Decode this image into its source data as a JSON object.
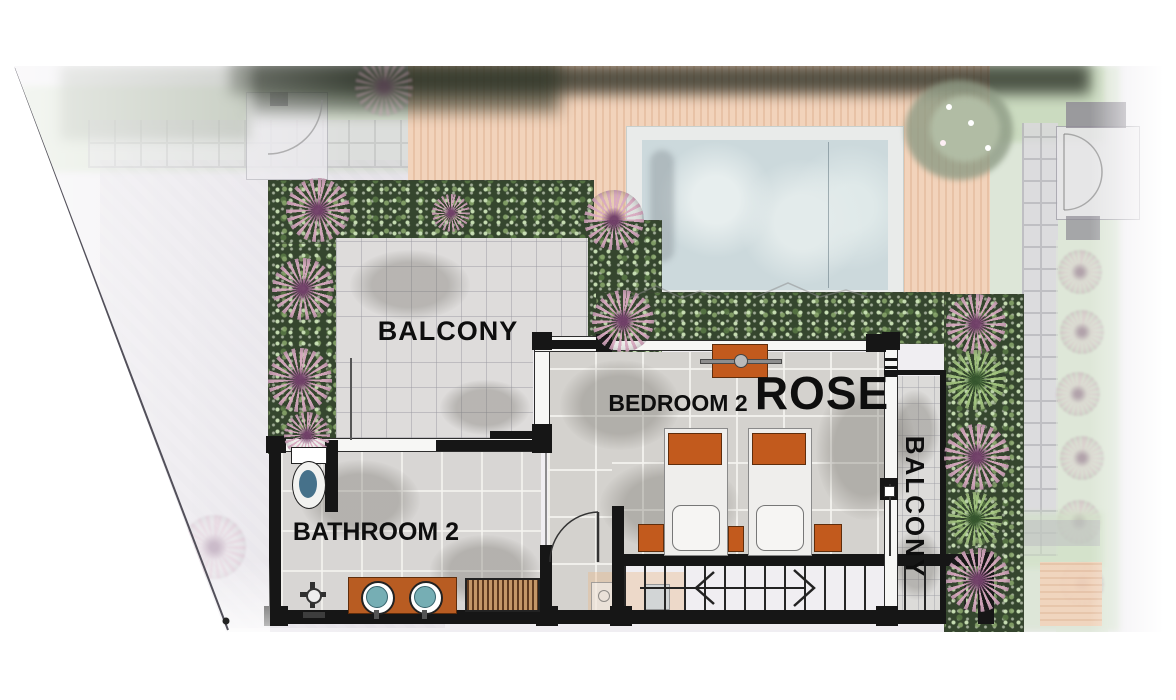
{
  "meta": {
    "type": "villa-upper-floor-plan"
  },
  "rooms": {
    "balcony_upper": {
      "label": "BALCONY"
    },
    "bedroom2": {
      "label": "BEDROOM 2"
    },
    "suite": {
      "label": "ROSE"
    },
    "balcony_side": {
      "label": "BALCONY"
    },
    "bathroom2": {
      "label": "BATHROOM 2"
    }
  },
  "features": [
    "swimming-pool",
    "timber-deck",
    "planter-hedge",
    "stepping-stones",
    "staircase",
    "twin-beds",
    "wardrobe",
    "double-vanity-sinks",
    "toilet",
    "shower",
    "entry-gate",
    "door-swing",
    "direction-arrow"
  ],
  "colors": {
    "deck": "#f0cfb4",
    "pool_water": "#ccd9dc",
    "hedge": "#35462e",
    "flower_pink": "#d0a4bc",
    "furniture_orange": "#c25a1d",
    "sink_teal": "#76aeb4",
    "tile_grey": "#d6d4d1",
    "wall_black": "#1a1a1a",
    "grass": "#cfe0c2"
  }
}
